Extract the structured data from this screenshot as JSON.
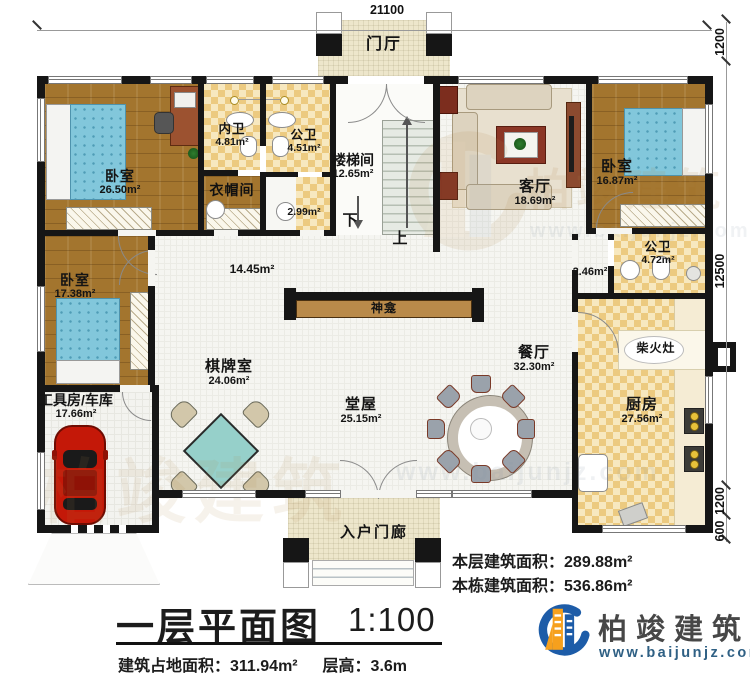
{
  "dimensions": {
    "top": "21100",
    "right_top": "1200",
    "right_main": "12500",
    "right_bottom": "1200",
    "right_steps": "600"
  },
  "rooms": {
    "menting": {
      "name": "门厅"
    },
    "bedroom_tl": {
      "name": "卧室",
      "area": "26.50m²"
    },
    "neiwei": {
      "name": "内卫",
      "area": "4.81m²"
    },
    "gongwei_top": {
      "name": "公卫",
      "area": "4.51m²"
    },
    "yimaojian": {
      "name": "衣帽间",
      "area": "2.99m²"
    },
    "loutijian": {
      "name": "楼梯间",
      "area": "12.65m²"
    },
    "keting": {
      "name": "客厅",
      "area": "18.69m²"
    },
    "bedroom_tr": {
      "name": "卧室",
      "area": "16.87m²"
    },
    "gongwei_right": {
      "name": "公卫",
      "area": "4.72m²"
    },
    "nook": {
      "area": "2.46m²"
    },
    "corridor": {
      "area": "14.45m²"
    },
    "shenkan": {
      "name": "神龛"
    },
    "canting": {
      "name": "餐厅",
      "area": "32.30m²"
    },
    "chaihuozao": {
      "name": "柴火灶"
    },
    "chufang": {
      "name": "厨房",
      "area": "27.56m²"
    },
    "bedroom_l": {
      "name": "卧室",
      "area": "17.38m²"
    },
    "qipaishi": {
      "name": "棋牌室",
      "area": "24.06m²"
    },
    "tangwu": {
      "name": "堂屋",
      "area": "25.15m²"
    },
    "garage": {
      "name": "工具房/车库",
      "area": "17.66m²"
    },
    "porch": {
      "name": "入户门廊"
    }
  },
  "stairs": {
    "down": "下",
    "up": "上"
  },
  "summary": {
    "floor_label": "本层建筑面积：",
    "floor_value": "289.88m²",
    "building_label": "本栋建筑面积：",
    "building_value": "536.86m²"
  },
  "titleblock": {
    "title": "一层平面图",
    "scale": "1:100",
    "footprint_label": "建筑占地面积：",
    "footprint_value": "311.94m²",
    "height_label": "层高：",
    "height_value": "3.6m"
  },
  "brand": {
    "name": "柏竣建筑",
    "website": "www.baijunjz.com"
  },
  "watermark": {
    "name": "柏竣建筑",
    "website": "www.baijunjz.com"
  },
  "colors": {
    "wall": "#161616",
    "wood": "#a3752e",
    "tile": "#ecca80",
    "accent_blue": "#1d5ca8",
    "accent_orange": "#f6a01d",
    "bed": "#7fc6da",
    "mahjong": "#96d0ca",
    "car": "#c41808"
  }
}
